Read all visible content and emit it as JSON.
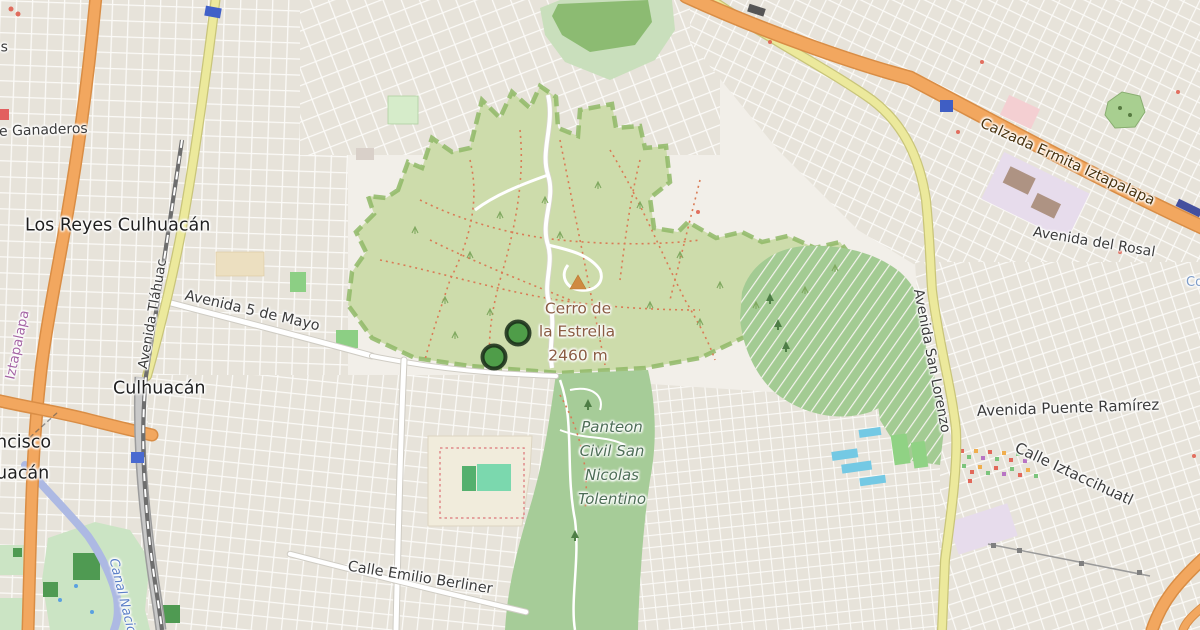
{
  "map": {
    "place_labels": {
      "los_reyes_culhuacan": "Los Reyes Culhuacán",
      "culhuacan": "Culhuacán",
      "san_francisco_fragment_line1": "ncisco",
      "san_francisco_fragment_line2": "uacán",
      "left_edge_fragment": "os",
      "right_edge_fragment": "Co"
    },
    "street_labels": {
      "ganaderos": "e Ganaderos",
      "avenida_5_de_mayo": "Avenida 5 de Mayo",
      "avenida_tlahuac": "Avenida Tláhuac",
      "calzada_ermita_iztapalapa": "Calzada Ermita Iztapalapa",
      "avenida_del_rosal": "Avenida del Rosal",
      "avenida_san_lorenzo": "Avenida San Lorenzo",
      "avenida_puente_ramirez": "Avenida Puente Ramírez",
      "calle_iztaccihuatl": "Calle Iztaccihuatl",
      "calle_emilio_berliner": "Calle Emilio Berliner"
    },
    "peak": {
      "name_line1": "Cerro de",
      "name_line2": "la Estrella",
      "elevation": "2460 m"
    },
    "cemetery_label": {
      "line1": "Panteon",
      "line2": "Civil San",
      "line3": "Nicolas",
      "line4": "Tolentino"
    },
    "boundary_label": "Iztapalapa",
    "waterway_label": "Canal Nacional",
    "markers": [
      {
        "shape": "circle",
        "color": "#4f9d49",
        "x": 518,
        "y": 333
      },
      {
        "shape": "circle",
        "color": "#4f9d49",
        "x": 494,
        "y": 357
      }
    ],
    "colors": {
      "land": "#f2efe9",
      "blocks": "#e7e3da",
      "park_reserve": "#cddcab",
      "park_boundary": "#8fb966",
      "green_area": "#a3cb93",
      "forest": "#8cbb72",
      "primary_road": "#f2a75f",
      "secondary_road": "#ece99c",
      "canal": "#adb9e3",
      "railway": "#6e6e6e",
      "station": "#4060c8",
      "pitch_teal": "#7bd8ae",
      "pool": "#74c9e4",
      "marker_green": "#4f9d49",
      "peak_icon": "#cf8a42",
      "trail": "#d97b55"
    }
  }
}
